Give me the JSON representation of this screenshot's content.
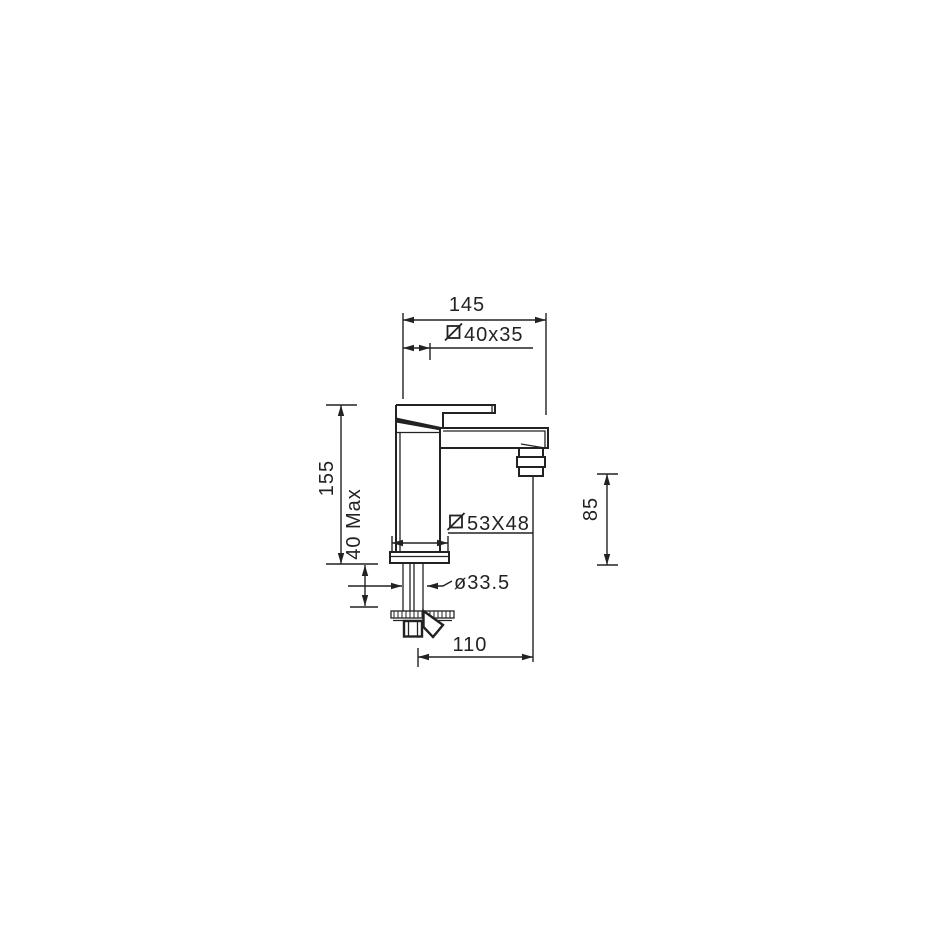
{
  "drawing": {
    "type": "faucet-installation-dimension-drawing",
    "dims": {
      "d145": "145",
      "d40x35": "40x35",
      "d155": "155",
      "d40max": "40 Max",
      "d85": "85",
      "d53x48": "53X48",
      "d335": "ø33.5",
      "d110": "110"
    },
    "symbols": {
      "square_section": "slashed-square (square cross-section symbol)"
    },
    "colors": {
      "line": "#222222",
      "background": "#ffffff"
    }
  }
}
